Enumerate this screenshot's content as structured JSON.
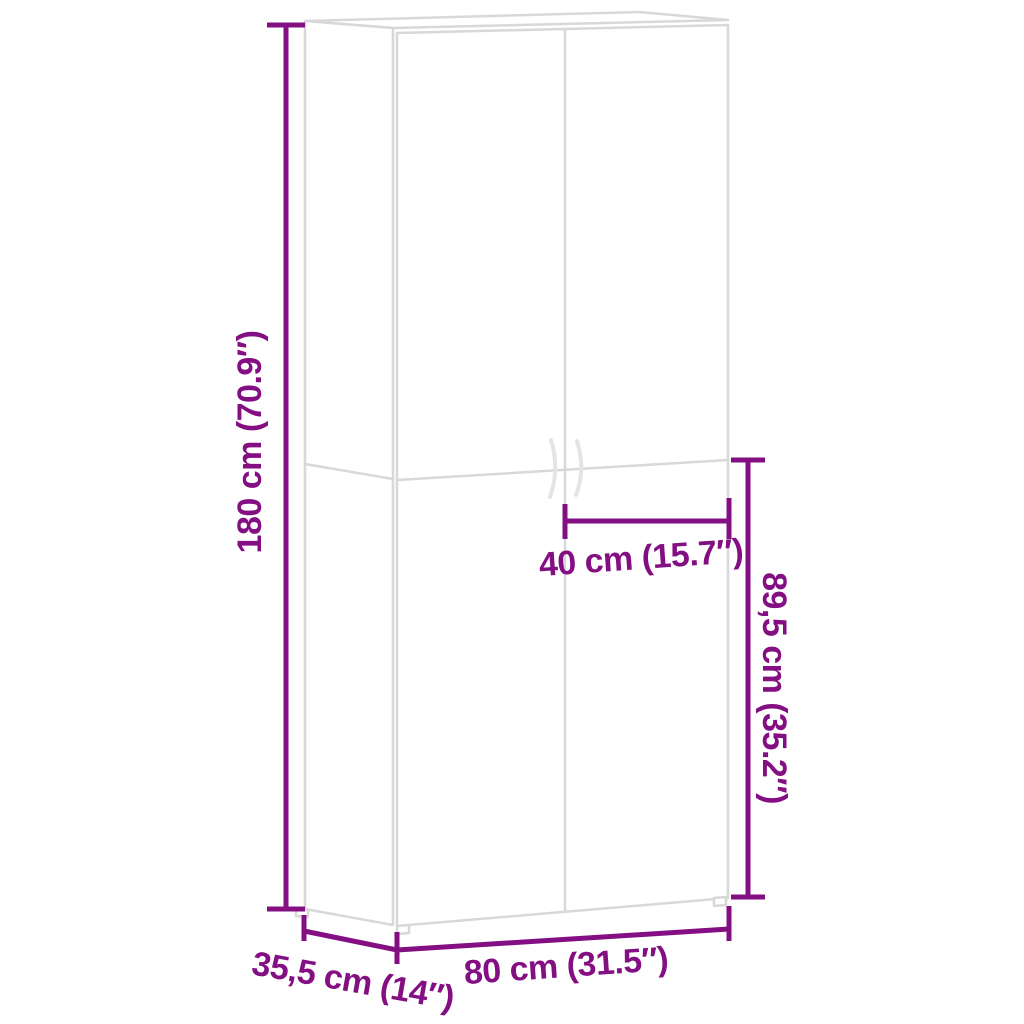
{
  "page": {
    "background": "#ffffff"
  },
  "colors": {
    "dimension_accent": "#830f83",
    "cabinet_outline": "#d8d8d8",
    "handle_outline": "#e4e4e4"
  },
  "diagram": {
    "kind": "furniture-dimension-diagram",
    "object": "two-door wardrobe cabinet",
    "labels": {
      "height": "180 cm (70.9″)",
      "lower_height": "89,5 cm (35.2″)",
      "door_width": "40 cm (15.7″)",
      "width": "80 cm (31.5″)",
      "depth": "35,5 cm (14″)"
    }
  }
}
